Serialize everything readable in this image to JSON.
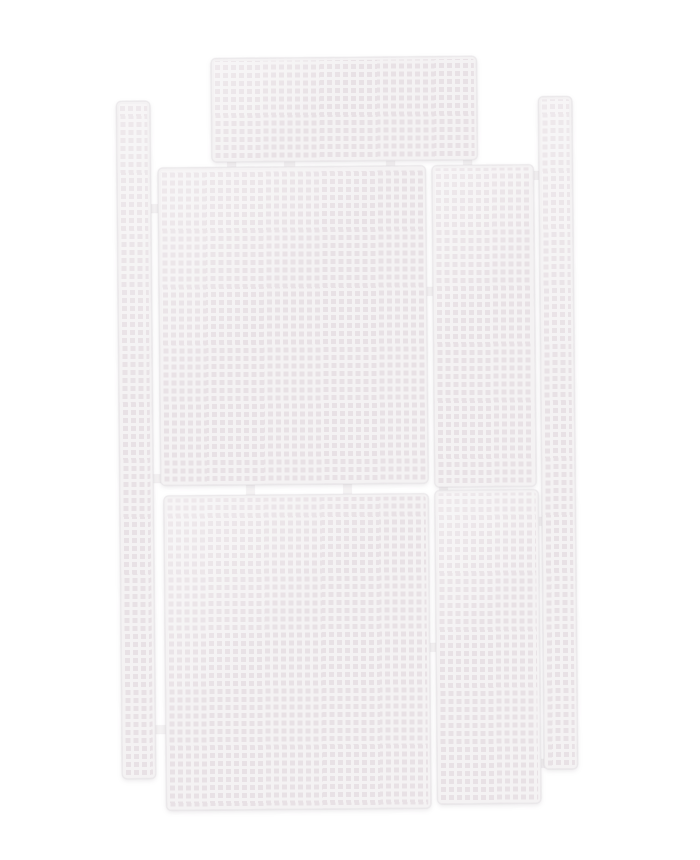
{
  "scene": {
    "subject": "white-plastic-canvas-mesh-sheet-set",
    "description": "Seven rectangular white plastic canvas mesh pieces joined by small sprue tabs, photographed flat on a white background",
    "background_color": "#ffffff",
    "mesh": {
      "hole_color": "#e8e1e5",
      "bar_color": "#f4f2f3",
      "edge_color": "#eceaec",
      "cell_pitch_px": 8,
      "bar_thickness_px": 3,
      "rotation_deg": -0.5
    },
    "pieces": [
      {
        "name": "mesh-panel-top-wide",
        "x": 214,
        "y": 57,
        "w": 266,
        "h": 104
      },
      {
        "name": "mesh-strip-left-edge",
        "x": 119,
        "y": 99,
        "w": 34,
        "h": 678
      },
      {
        "name": "mesh-panel-upper-left-large",
        "x": 160,
        "y": 166,
        "w": 268,
        "h": 318
      },
      {
        "name": "mesh-panel-upper-right-narrow",
        "x": 434,
        "y": 166,
        "w": 102,
        "h": 322
      },
      {
        "name": "mesh-strip-right-edge",
        "x": 541,
        "y": 98,
        "w": 34,
        "h": 673
      },
      {
        "name": "mesh-panel-lower-left-large",
        "x": 163,
        "y": 494,
        "w": 265,
        "h": 315
      },
      {
        "name": "mesh-panel-lower-right-narrow",
        "x": 434,
        "y": 491,
        "w": 104,
        "h": 314
      }
    ],
    "connectors": [
      {
        "x": 230,
        "y": 157,
        "w": 8,
        "h": 13
      },
      {
        "x": 287,
        "y": 157,
        "w": 10,
        "h": 13
      },
      {
        "x": 389,
        "y": 157,
        "w": 8,
        "h": 13
      },
      {
        "x": 466,
        "y": 157,
        "w": 8,
        "h": 13
      },
      {
        "x": 246,
        "y": 480,
        "w": 8,
        "h": 18
      },
      {
        "x": 343,
        "y": 480,
        "w": 8,
        "h": 18
      },
      {
        "x": 439,
        "y": 483,
        "w": 8,
        "h": 13
      },
      {
        "x": 149,
        "y": 203,
        "w": 14,
        "h": 8
      },
      {
        "x": 149,
        "y": 473,
        "w": 14,
        "h": 8
      },
      {
        "x": 151,
        "y": 724,
        "w": 14,
        "h": 8
      },
      {
        "x": 532,
        "y": 173,
        "w": 12,
        "h": 8
      },
      {
        "x": 534,
        "y": 519,
        "w": 12,
        "h": 8
      },
      {
        "x": 536,
        "y": 761,
        "w": 12,
        "h": 8
      },
      {
        "x": 424,
        "y": 288,
        "w": 13,
        "h": 8
      },
      {
        "x": 424,
        "y": 644,
        "w": 13,
        "h": 8
      }
    ]
  }
}
